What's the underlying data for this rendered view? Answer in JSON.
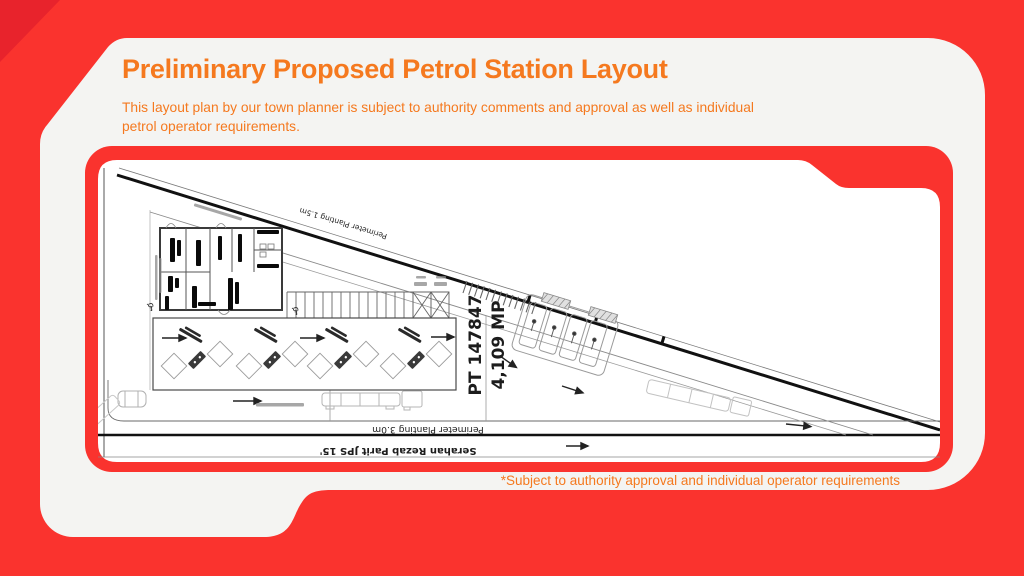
{
  "slide": {
    "title": "Preliminary Proposed Petrol Station Layout",
    "subtitle_line1": "This layout plan by our town planner is subject to authority comments and approval as well as individual",
    "subtitle_line2": "petrol operator requirements.",
    "footnote": "*Subject to authority approval and individual operator requirements"
  },
  "colors": {
    "background_red": "#fa332e",
    "corner_accent_red": "#e8232c",
    "card_offwhite": "#f4f4f2",
    "accent_orange": "#f5791f",
    "plan_paper_white": "#ffffff",
    "plan_line_dark": "#1a1a1a"
  },
  "site_plan": {
    "lot_number": "PT 147847",
    "lot_area": "4,109 MP",
    "perimeter_planting_road": "Perimeter Planting 1.5m",
    "perimeter_planting_rear": "Perimeter Planting 3.0m",
    "drain_reserve_note": "Serahan Rezab Parit JPS 15'",
    "disabled_parking_symbol": "♿"
  }
}
